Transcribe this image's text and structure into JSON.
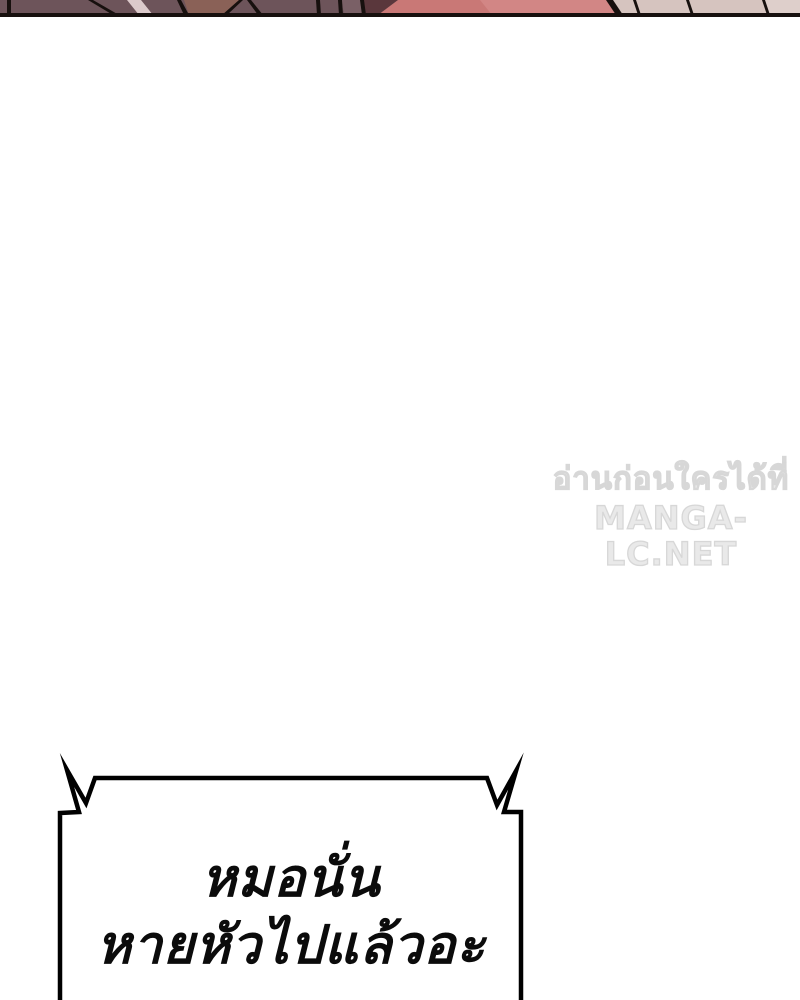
{
  "page": {
    "background": "#ffffff"
  },
  "art_strip": {
    "description": "bottom-sliver-of-previous-panel-artwork",
    "colors": {
      "mauve": "#6d545a",
      "mauve_light": "#7a6066",
      "streak": "#dccacb",
      "brown": "#8a6157",
      "maroon": "#5a373c",
      "pink": "#c97876",
      "pink_light": "#d28685",
      "beige": "#d6c4bf",
      "beige_light": "#decfcb",
      "line": "#17100e"
    }
  },
  "watermark": {
    "line1": "อ่านก่อนใครได้ที่",
    "line2": "MANGA-LC.NET",
    "color": "#e7e7e7"
  },
  "speech_bubble": {
    "line1": "หมอนั่น",
    "line2": "หายหัวไปแล้วอะ",
    "border_color": "#000000",
    "fill_color": "#ffffff",
    "text_color": "#0b0b0b"
  }
}
